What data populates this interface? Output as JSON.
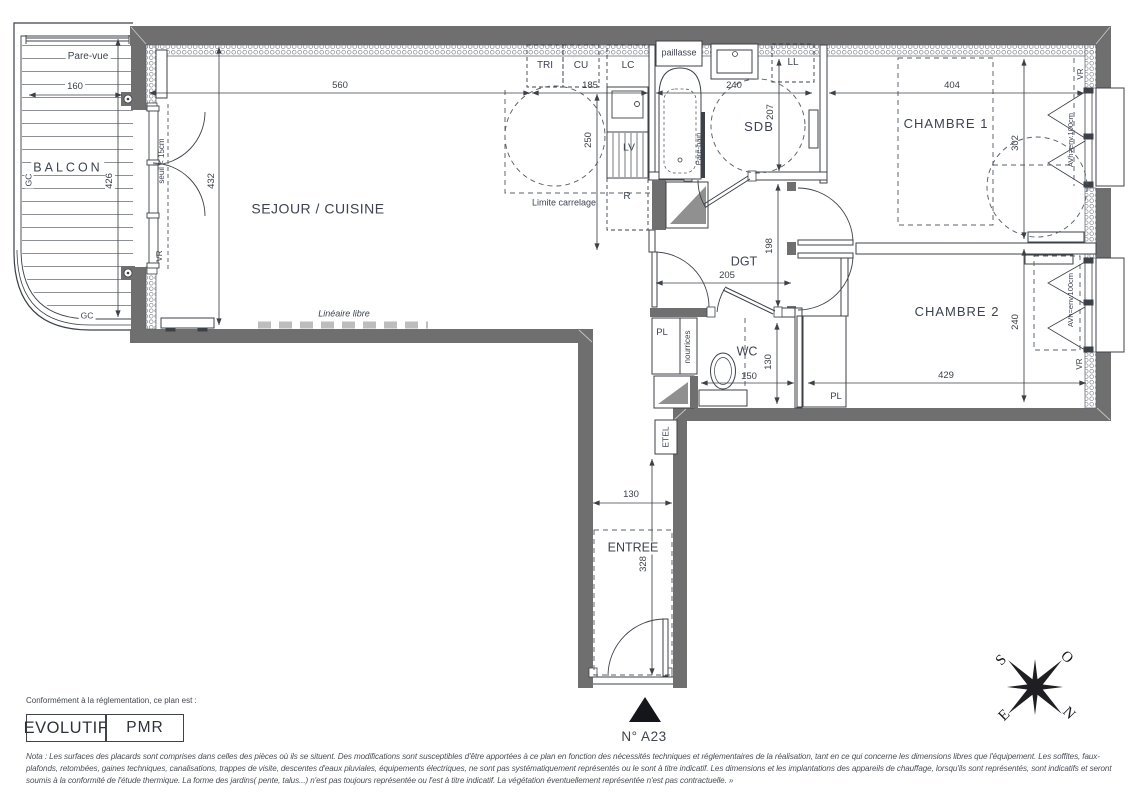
{
  "plan": {
    "balcony": {
      "name": "BALCON",
      "screen": "Pare-vue",
      "guardrail_left": "GC",
      "guardrail_bottom": "GC",
      "width": "160",
      "depth": "426"
    },
    "living": {
      "name": "SEJOUR / CUISINE",
      "width": "560",
      "depth": "432",
      "threshold": "seuil < 15cm",
      "shutter": "VR",
      "free_linear": "Linéaire libre"
    },
    "kitchen": {
      "sorting": "TRI",
      "cooking": "CU",
      "column": "LC",
      "sink": "LV",
      "fridge": "R",
      "tile_limit": "Limite carrelage",
      "width": "185",
      "depth": "250"
    },
    "bathroom": {
      "name": "SDB",
      "counter": "paillasse",
      "washing_machine": "LL",
      "bath_screen": "Pare-bain",
      "width": "240",
      "depth": "207"
    },
    "bedroom1": {
      "name": "CHAMBRE 1",
      "width": "404",
      "depth": "302",
      "shutter": "VR",
      "window_sill": "AVh=env.100cm"
    },
    "bedroom2": {
      "name": "CHAMBRE 2",
      "width": "429",
      "depth": "240",
      "shutter": "VR",
      "window_sill": "AVh=env.100cm"
    },
    "hallway": {
      "name": "DGT",
      "width": "205",
      "depth": "198"
    },
    "wc": {
      "name": "WC",
      "closet": "PL",
      "manifolds": "nourrices",
      "closet_right": "PL",
      "width": "150",
      "depth": "130"
    },
    "entry": {
      "name": "ENTREE",
      "electrical_closet": "ETEL",
      "width": "130",
      "depth": "328"
    },
    "unit_number": "N° A23"
  },
  "compass": {
    "south": "S",
    "west": "O",
    "east": "E",
    "north": "N"
  },
  "legend": {
    "caption": "Conformément à la réglementation, ce plan est :",
    "evolutif": "EVOLUTIF",
    "pmr": "PMR"
  },
  "nota": "Nota : Les surfaces des placards sont comprises dans celles des pièces où ils se situent. Des modifications sont susceptibles d'être apportées à ce plan en fonction des nécessités techniques et réglementaires de la réalisation, tant en ce qui concerne les dimensions libres que l'équipement.  Les soffites, faux-plafonds, retombées, gaines techniques, canalisations, trappes de visite, descentes d'eaux pluviales, équipements électriques, ne sont pas systématiquement représentés ou le sont à titre indicatif. Les dimensions et les implantations des appareils de chauffage, lorsqu'ils sont représentés, sont indicatifs et seront soumis à la conformité de l'étude thermique. La forme des jardins( pente, talus...) n'est pas toujours représentée ou l'est à titre indicatif. La végétation éventuellement représentée n'est pas contractuelle. »",
  "colors": {
    "wall": "#6f6f6f",
    "line": "#3c4148",
    "text": "#3d4350"
  }
}
